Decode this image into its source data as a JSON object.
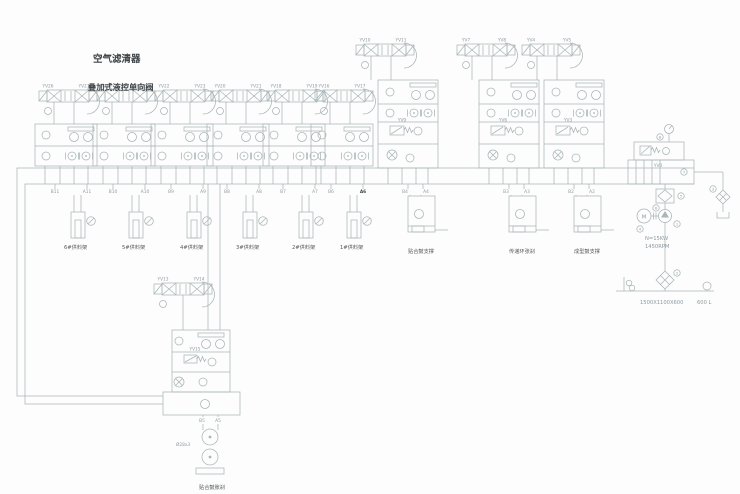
{
  "diagram": {
    "titles": {
      "air_filter": "空气滤清器",
      "stacked_valve": "叠加式液控单向阀"
    },
    "feeder_groups": [
      {
        "yv_left": "YV26",
        "yv_right": "YV27",
        "port_b": "B11",
        "port_a": "A11",
        "cylinder": "6#供料架"
      },
      {
        "yv_left": "YV24",
        "yv_right": "YV25",
        "port_b": "B10",
        "port_a": "A10",
        "cylinder": "5#供料架"
      },
      {
        "yv_left": "YV22",
        "yv_right": "YV23",
        "port_b": "B9",
        "port_a": "A9",
        "cylinder": "4#供料架"
      },
      {
        "yv_left": "YV20",
        "yv_right": "YV21",
        "port_b": "B8",
        "port_a": "A8",
        "cylinder": "3#供料架"
      },
      {
        "yv_left": "YV18",
        "yv_right": "YV19",
        "port_b": "B7",
        "port_a": "A7",
        "cylinder": "2#供料架"
      },
      {
        "yv_left": "YV16",
        "yv_right": "YV17",
        "port_b": "B6",
        "port_a": "A6",
        "cylinder": "1#供料架"
      }
    ],
    "tall_stacks": [
      {
        "yv_left": "YV10",
        "yv_right": "YV11",
        "yv_mid": "YV9",
        "port_b": "B4",
        "port_a": "A4",
        "cylinder": "贴合鼓支撑"
      },
      {
        "yv_left": "YV7",
        "yv_right": "YV8",
        "yv_mid": "YV6",
        "port_b": "B3",
        "port_a": "A3",
        "cylinder": "传递环张刹"
      },
      {
        "yv_left": "YV4",
        "yv_right": "YV5",
        "yv_mid": "YV3",
        "port_b": "B2",
        "port_a": "A2",
        "cylinder": "成型鼓支撑"
      }
    ],
    "lower_stack": {
      "yv_left": "YV13",
      "yv_right": "YV14",
      "yv_mid": "YV15",
      "port_b": "B5",
      "port_a": "A5",
      "pipe_spec": "Ø28x3",
      "cylinder": "贴合鼓胀刹"
    },
    "power_unit": {
      "relief_valve": "YV0",
      "motor_label": "M",
      "motor_power": "N=15KW",
      "motor_speed": "1450RPM",
      "tank_size": "1500X1100X600",
      "tank_volume": "600 L"
    },
    "callouts": [
      {
        "n": "1"
      },
      {
        "n": "2"
      },
      {
        "n": "3"
      },
      {
        "n": "4"
      },
      {
        "n": "5"
      },
      {
        "n": "6"
      },
      {
        "n": "7"
      },
      {
        "n": "8"
      }
    ],
    "colors": {
      "line": "#a9b5b6",
      "text": "#8d9aa0",
      "dark_text": "#3e4447"
    }
  }
}
